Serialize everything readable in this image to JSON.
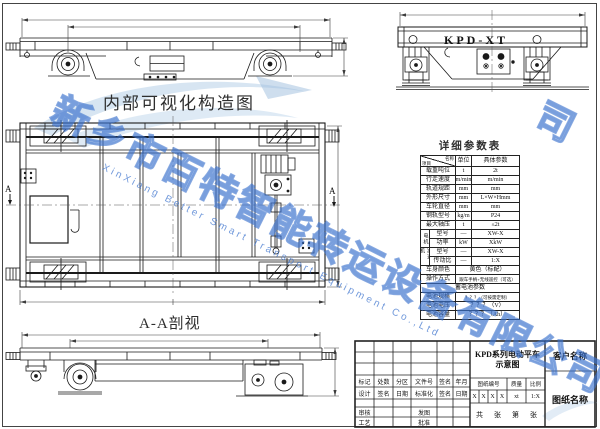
{
  "captions": {
    "plan_view": "内部可视化构造图",
    "section_view": "A-A剖视",
    "end_view_model": "KPD-XT",
    "section_marker": "A"
  },
  "param_table": {
    "title": "详细参数表",
    "header": {
      "corner_top": "名称",
      "corner_bottom": "项目",
      "unit": "单位",
      "value": "具体参数"
    },
    "rows": [
      {
        "label": "载重吨位",
        "unit": "t",
        "value": "2t"
      },
      {
        "label": "行走速度",
        "unit": "m/min",
        "value": "m/min"
      },
      {
        "label": "轨道规距",
        "unit": "mm",
        "value": "mm"
      },
      {
        "label": "外形尺寸",
        "unit": "mm",
        "value": "L×W×Hmm"
      },
      {
        "label": "车轮直径",
        "unit": "mm",
        "value": "mm"
      },
      {
        "label": "钢轨型号",
        "unit": "kg/m",
        "value": "P24"
      },
      {
        "label": "最大轴压",
        "unit": "t",
        "value": "≤2t"
      }
    ],
    "motor_group": {
      "name": "电机",
      "rows": [
        {
          "label": "型号",
          "unit": "—",
          "value": "XW-X"
        },
        {
          "label": "功率",
          "unit": "kW",
          "value": "XkW"
        }
      ]
    },
    "reducer_group": {
      "name": "减速机",
      "rows": [
        {
          "label": "型号",
          "unit": "—",
          "value": "XW-X"
        },
        {
          "label": "传动比",
          "unit": "—",
          "value": "1:X"
        }
      ]
    },
    "color_row": {
      "label": "车身颜色",
      "value": "黄色（标配）"
    },
    "operation_row": {
      "label": "操作方式",
      "value": "跟车手柄+无线遥控（可选）"
    },
    "battery_header": "蓄电池参数",
    "battery_rows": [
      {
        "label": "电池规格",
        "value": "？？？（可按需定制）"
      },
      {
        "label": "电池电压",
        "value": "？？？（V）"
      },
      {
        "label": "电池容量",
        "value": "？？？（Ah）"
      }
    ]
  },
  "title_block": {
    "revision_header": [
      "标记",
      "处数",
      "分区",
      "文件号",
      "签名",
      "年月"
    ],
    "design_row": [
      "设计",
      "签名",
      "日期",
      "标准化",
      "签名",
      "日期"
    ],
    "audit_label": "审核",
    "issue_label": "发图",
    "process_label": "工艺",
    "approve_label": "批准",
    "product_title": "KPD系列电动平车",
    "product_subtitle": "示意图",
    "customer_label": "客户名称",
    "drawing_name_label": "图纸名称",
    "meta_labels": [
      "图纸编号",
      "质量",
      "比例"
    ],
    "drawing_no_cells": [
      "X",
      "X",
      "X",
      "X"
    ],
    "weight_value": "xt",
    "scale_value": "1:X",
    "sheet_info": "共　张　第　张"
  },
  "watermark": {
    "company_cn": "新乡市百特智能转运设备有限公司",
    "company_en": "XinXiang Better Smart Transport Equipment Co.,Ltd",
    "fragment": "司",
    "blue": "#3a72cd",
    "light_blue": "#b6d0e8"
  }
}
